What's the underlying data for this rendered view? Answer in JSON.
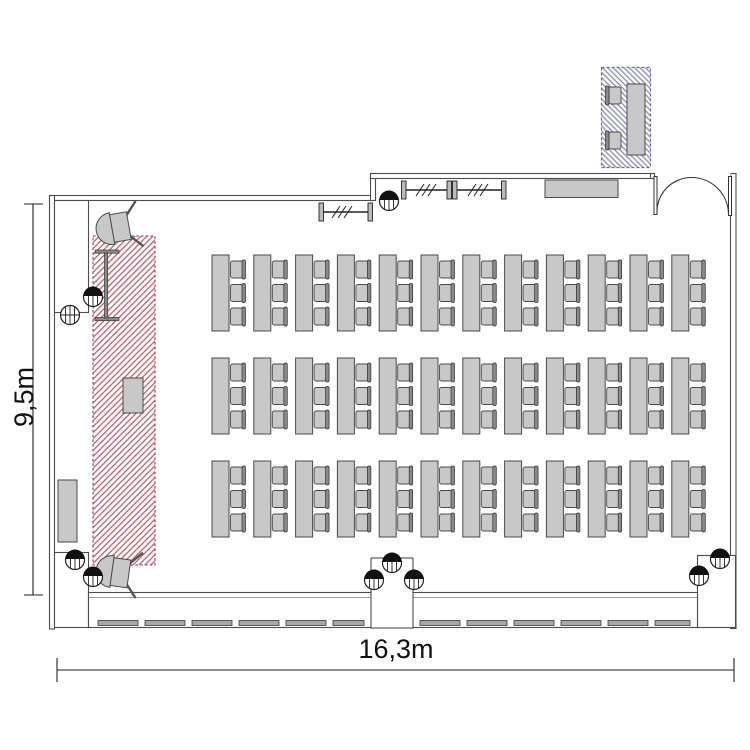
{
  "page": {
    "background": "#ffffff",
    "drawing_type": "room-floor-plan-seminar-seating"
  },
  "labels": {
    "room_height": "9,5m",
    "room_width": "16,3m"
  },
  "colors": {
    "wall": "#4d4d4d",
    "wall_light": "#9a9a9a",
    "furniture_fill": "#c8c8c8",
    "furniture_stroke": "#4a4a4a",
    "stage_hatch": "#c05a70",
    "stage_border": "#b05565",
    "annex_hatch": "#8c8cb4",
    "annex_border": "#6b6b9e"
  },
  "seating": {
    "rows": 3,
    "columns": 12,
    "chairs_per_table": 3,
    "tables_total": 36,
    "seats_total": 108
  },
  "annex": {
    "tables": 1,
    "chairs": 2
  },
  "fixtures": [
    "stage-hatched-zone",
    "annex-hatched-zone",
    "double-door",
    "window-band",
    "center-pillar",
    "coat-rack-left",
    "coat-rack-right",
    "sideboard",
    "radiator",
    "lectern",
    "presentation-board",
    "speaker-top",
    "speaker-bottom",
    "spotlights"
  ]
}
